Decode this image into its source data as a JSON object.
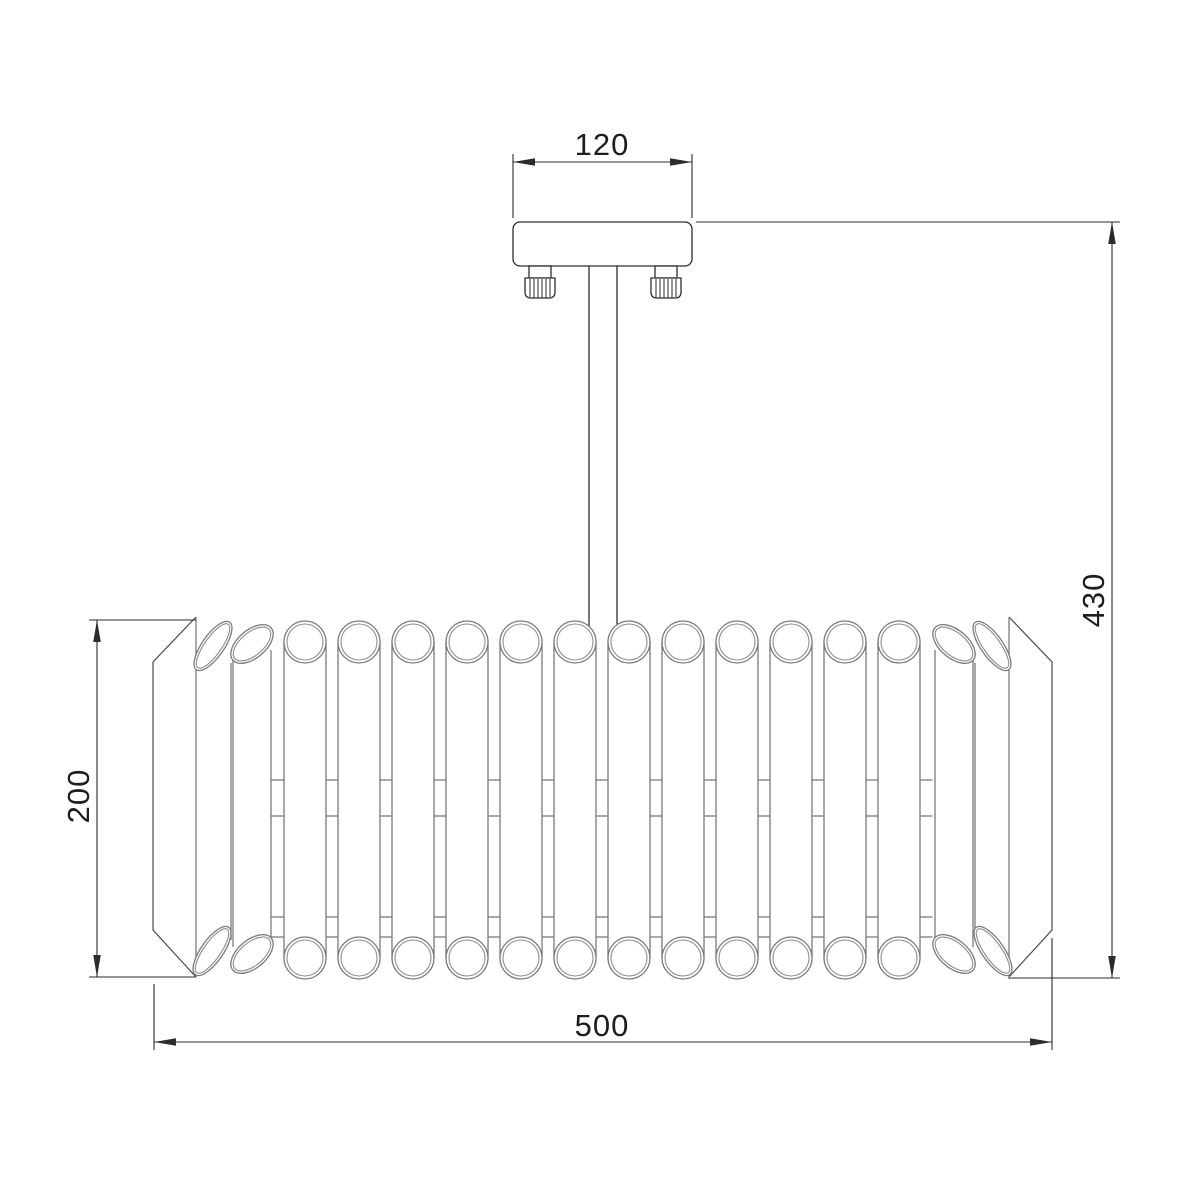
{
  "drawing": {
    "kind": "technical-dimension-drawing",
    "subject": "crystal tube ceiling chandelier, front elevation",
    "background": "#ffffff",
    "line_color": "#2d2d2d",
    "tube_line_color": "#7b7b7b",
    "dims": {
      "canopy_width": "120",
      "overall_height": "430",
      "shade_height": "200",
      "shade_width": "500"
    },
    "shade": {
      "tube_count_total": 16,
      "circular_tubes": 12,
      "angled_tubes_per_side": 2
    }
  }
}
